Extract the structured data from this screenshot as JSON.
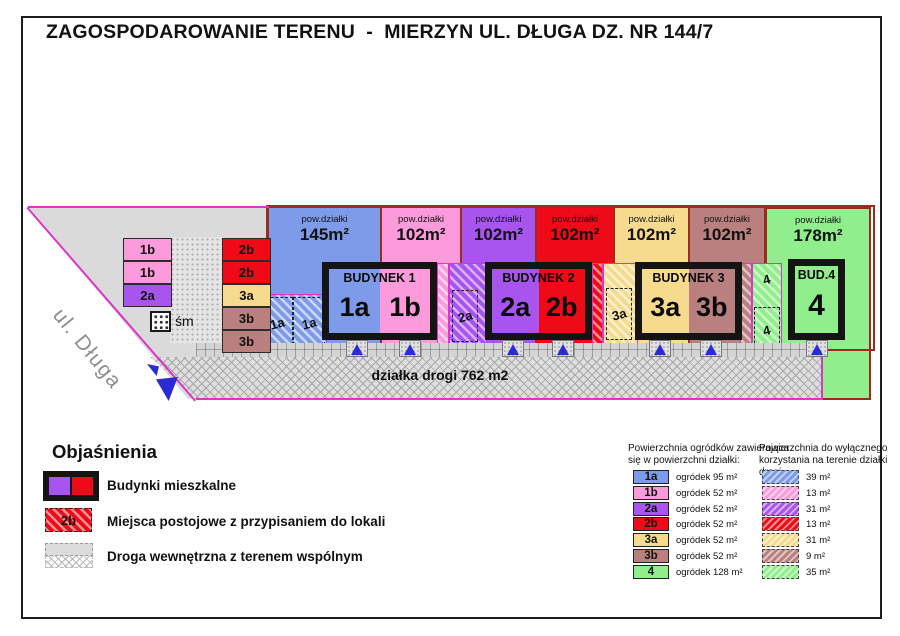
{
  "title": "ZAGOSPODAROWANIE TERENU  -  MIERZYN UL. DŁUGA DZ. NR 144/7",
  "plan": {
    "street_label": "ul. Długa",
    "road_label": "działka drogi 762 m2",
    "waste_label": "śm",
    "plot_caption": "pow.działki",
    "plots": [
      {
        "area": "145m²"
      },
      {
        "area": "102m²"
      },
      {
        "area": "102m²"
      },
      {
        "area": "102m²"
      },
      {
        "area": "102m²"
      },
      {
        "area": "102m²"
      },
      {
        "area": "178m²"
      }
    ],
    "buildings": [
      {
        "name": "BUDYNEK 1",
        "units": [
          "1a",
          "1b"
        ]
      },
      {
        "name": "BUDYNEK 2",
        "units": [
          "2a",
          "2b"
        ]
      },
      {
        "name": "BUDYNEK 3",
        "units": [
          "3a",
          "3b"
        ]
      },
      {
        "name": "BUD.4",
        "units": [
          "4"
        ]
      }
    ],
    "parking_left_a": [
      "1b",
      "1b",
      "2a"
    ],
    "parking_left_b": [
      "2b",
      "2b",
      "3a",
      "3b",
      "3b"
    ],
    "parking_road_1a": [
      "1a",
      "1a"
    ],
    "parking_strip_2a": "2a",
    "parking_strip_3a": "3a",
    "strip_4_top": "4",
    "parking_strip_4": "4"
  },
  "legend": {
    "heading": "Objaśnienia",
    "item_buildings": "Budynki mieszkalne",
    "item_parking_swatch": "2b",
    "item_parking": "Miejsca postojowe z przypisaniem do lokali",
    "item_road": "Droga wewnętrzna z terenem wspólnym"
  },
  "tables": {
    "gardens": {
      "title_line1": "Powierzchnia ogródków zawierająca",
      "title_line2": "się w powierzchni działki:",
      "rows": [
        {
          "key": "1a",
          "value": "ogródek 95 m²"
        },
        {
          "key": "1b",
          "value": "ogródek 52 m²"
        },
        {
          "key": "2a",
          "value": "ogródek 52 m²"
        },
        {
          "key": "2b",
          "value": "ogródek 52 m²"
        },
        {
          "key": "3a",
          "value": "ogródek 52 m²"
        },
        {
          "key": "3b",
          "value": "ogródek 52 m²"
        },
        {
          "key": "4",
          "value": "ogródek 128 m²"
        }
      ]
    },
    "exclusive": {
      "title_line1": "Powierzchnia do wyłącznego",
      "title_line2": "korzystania na terenie działki drogi",
      "rows": [
        {
          "value": "39 m²"
        },
        {
          "value": "13 m²"
        },
        {
          "value": "31 m²"
        },
        {
          "value": "13 m²"
        },
        {
          "value": "31 m²"
        },
        {
          "value": "9 m²"
        },
        {
          "value": "35 m²"
        }
      ]
    }
  },
  "colors": {
    "unit_1a_blue": "#7D9BE8",
    "unit_1b_pink": "#FC9BDC",
    "unit_2a_purple": "#A855F0",
    "unit_2b_red": "#EE0A16",
    "unit_3a_yellow": "#F6DB8E",
    "unit_3b_brown": "#BA8080",
    "unit_4_green": "#90EE8C",
    "boundary_magenta": "#DB35CC",
    "plot_border_dark_red": "#9C2B1F",
    "common_area_gray": "#DADADA",
    "marker_blue": "#2B2BD5"
  }
}
